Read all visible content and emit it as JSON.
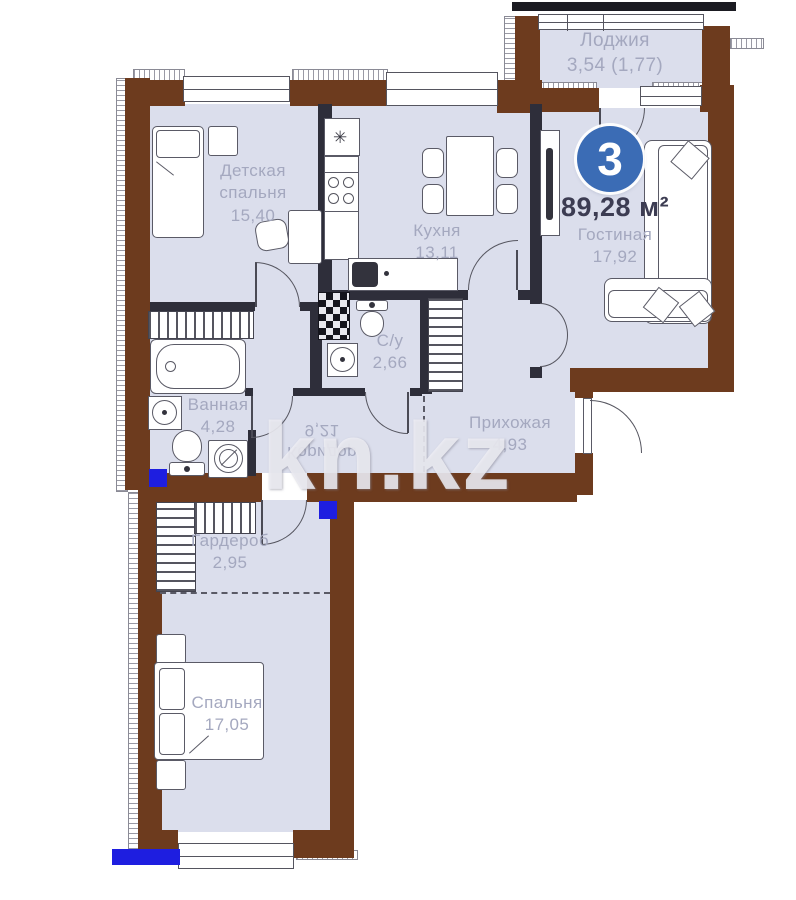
{
  "watermark": "kn.kz",
  "unit": {
    "rooms_number": "3",
    "total_area": "89,28",
    "area_unit": "м²"
  },
  "rooms": {
    "loggia": {
      "name": "Лоджия",
      "area": "3,54 (1,77)"
    },
    "kids": {
      "name_l1": "Детская",
      "name_l2": "спальня",
      "area": "15,40"
    },
    "kitchen": {
      "name": "Кухня",
      "area": "13,11"
    },
    "living": {
      "name": "Гостиная",
      "area": "17,92"
    },
    "bath": {
      "name": "Ванная",
      "area": "4,28"
    },
    "wc": {
      "name": "С/у",
      "area": "2,66"
    },
    "corridor": {
      "name": "Коридор",
      "area": "9,21"
    },
    "hall": {
      "name": "Прихожая",
      "area": "4,93"
    },
    "wardrobe": {
      "name": "Гардероб",
      "area": "2,95"
    },
    "bedroom": {
      "name": "Спальня",
      "area": "17,05"
    }
  },
  "icons": {
    "kitchen_star": "✳"
  },
  "colors": {
    "wall_brown": "#6d3b1e",
    "interior_wall": "#2e2e3a",
    "room_fill": "#dbdeec",
    "accent_circle_blue": "#3b6cb5",
    "marker_blue": "#1e1ee0",
    "label_gray": "#a4a8bf"
  }
}
